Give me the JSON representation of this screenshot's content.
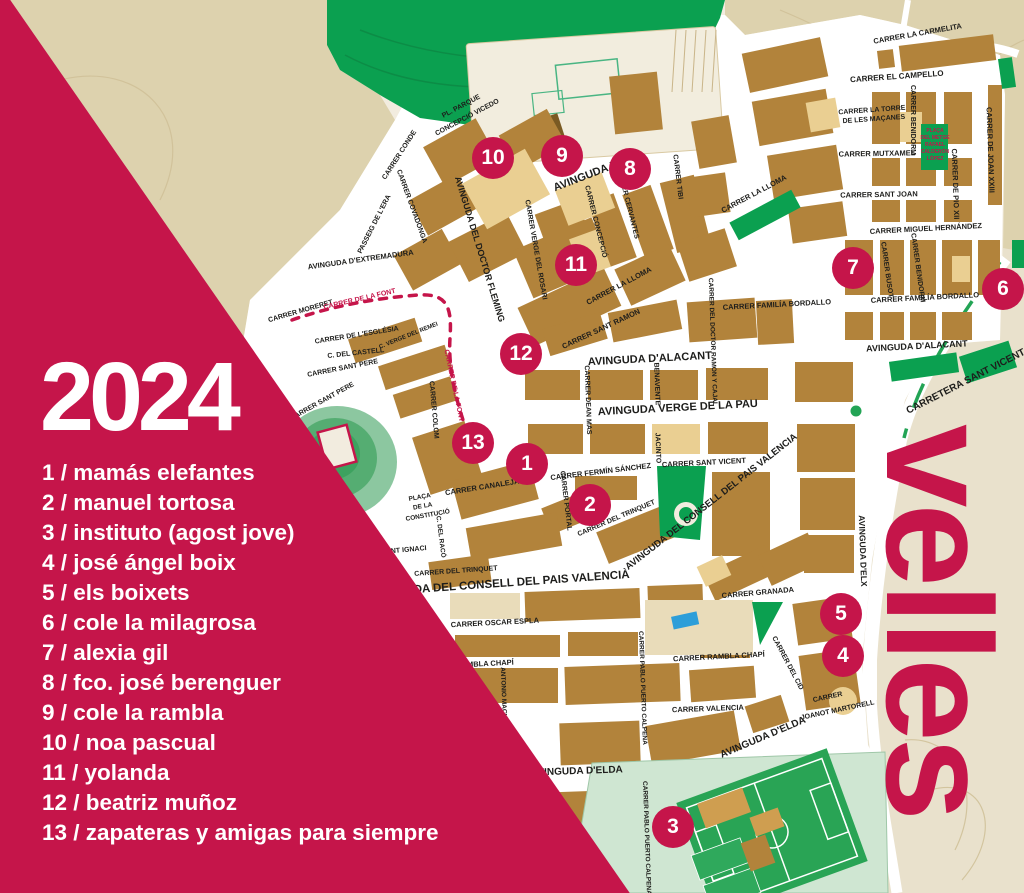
{
  "poster": {
    "year_title": "2024",
    "wordmark": "velles"
  },
  "legend": {
    "items": [
      "1 / mamás elefantes",
      "2 / manuel tortosa",
      "3 / instituto (agost jove)",
      "4 / josé ángel boix",
      "5 / els boixets",
      "6 / cole la milagrosa",
      "7 / alexia gil",
      "8 / fco. josé berenguer",
      "9 / cole la rambla",
      "10 / noa pascual",
      "11 / yolanda",
      "12 / beatriz muñoz",
      "13 / zapateras y amigas para siempre"
    ]
  },
  "map": {
    "markers": [
      "1",
      "2",
      "3",
      "4",
      "5",
      "6",
      "7",
      "8",
      "9",
      "10",
      "11",
      "12",
      "13"
    ],
    "labels": [
      "CARRER LA CARMELITA",
      "CARRER EL CAMPELLO",
      "CARRER LA TORRE",
      "DE LES MAÇANES",
      "CARRER MUTXAMEL",
      "CARRER SANT JOAN",
      "CARRER MIGUEL HERNÁNDEZ",
      "CARRER BENIDORM",
      "CARRER BENIDORM",
      "CARRER BUSOT",
      "CARRER DE PIO XII",
      "CARRER DE JOAN XXIII",
      "CARRER FAMILÍA BORDALLO",
      "CARRER FAMILÍA BORDALLO",
      "AVINGUDA D'ALACANT",
      "AVINGUDA D'ALACANT",
      "CARRETERA SANT VICENT",
      "AVINGUDA D",
      "CARRER TIBI",
      "CARRER CERVANTES",
      "CARRER CONCEPCIÓ",
      "CARRER VERGE DEL ROSARI",
      "CARRER LA LLOMA",
      "CARRER LA LLOMA",
      "CARRER SANT RAMON",
      "CARRER DEL DOCTOR RAMON Y CAJAL",
      "PL. PARQUE",
      "CONCEPCIÓ VICEDO",
      "CARRER CONDE",
      "CARRER COVADONGA",
      "PASSEIG DE L'ERA",
      "AVINGUDA D'EXTREMADURA",
      "AVINGUDA DEL DOCTOR FLEMING",
      "CARRER MORERET",
      "CARRER DE LA FONT",
      "CARRER DE LA FONT",
      "CARRER DE L'ESGLÉSIA",
      "C. DEL CASTELL",
      "CARRER SANT PERE",
      "CARRER SANT PERE",
      "C. VERGE DEL REMEI",
      "CARRER COLOM",
      "AVINGUDA VERGE DE LA PAU",
      "CARRER DEAN MAS",
      "BENAVENTE",
      "JACINTO",
      "CARRER SANT VICENT",
      "CARRER FERMÍN SÁNCHEZ",
      "CARRER CANALEJAS",
      "PLAÇA",
      "DE LA",
      "CONSTITUCIÓ",
      "CARRER PORTAL",
      "SANT IGNACI",
      "C. DEL RACÓ",
      "CARRER DEL TRINQUET",
      "AVINGUDA DEL CONSELL DEL PAIS VALENCIA",
      "CARRER DEL TRINQUET",
      "AVINGUDA DEL CONSELL DEL PAIS VALENCIÀ",
      "CARRER GRANADA",
      "CARRER OSCAR ESPLA",
      "CARRER RAMBLA CHAPÍ",
      "CARRER RAMBLA CHAPÍ",
      "CARRER DEL CID",
      "CARRER VALENCIA",
      "CARRER PABLO PUERTO CALPENA",
      "CARRER PABLO PUERTO CALPENA",
      "CARRER",
      "JOANOT MARTORELL",
      "AVINGUDA D'ELDA",
      "AVINGUDA D'ELDA",
      "AVINGUDA D'ELX",
      "ANTONIO MACHADO"
    ],
    "plaza": [
      "PLAÇA",
      "DEL METGE",
      "RAFAEL",
      "CALDERÓN",
      "LÓPEZ"
    ],
    "colors": {
      "accent": "#c5154a",
      "block_dark": "#b2833b",
      "block_light": "#eacf92",
      "street": "#ffffff",
      "map_cream": "#f2ecdf",
      "terrain": "#ddd2ae",
      "beige": "#e9e1cc",
      "park_green": "#0ba050",
      "pool_blue": "#2d9ed9"
    }
  }
}
